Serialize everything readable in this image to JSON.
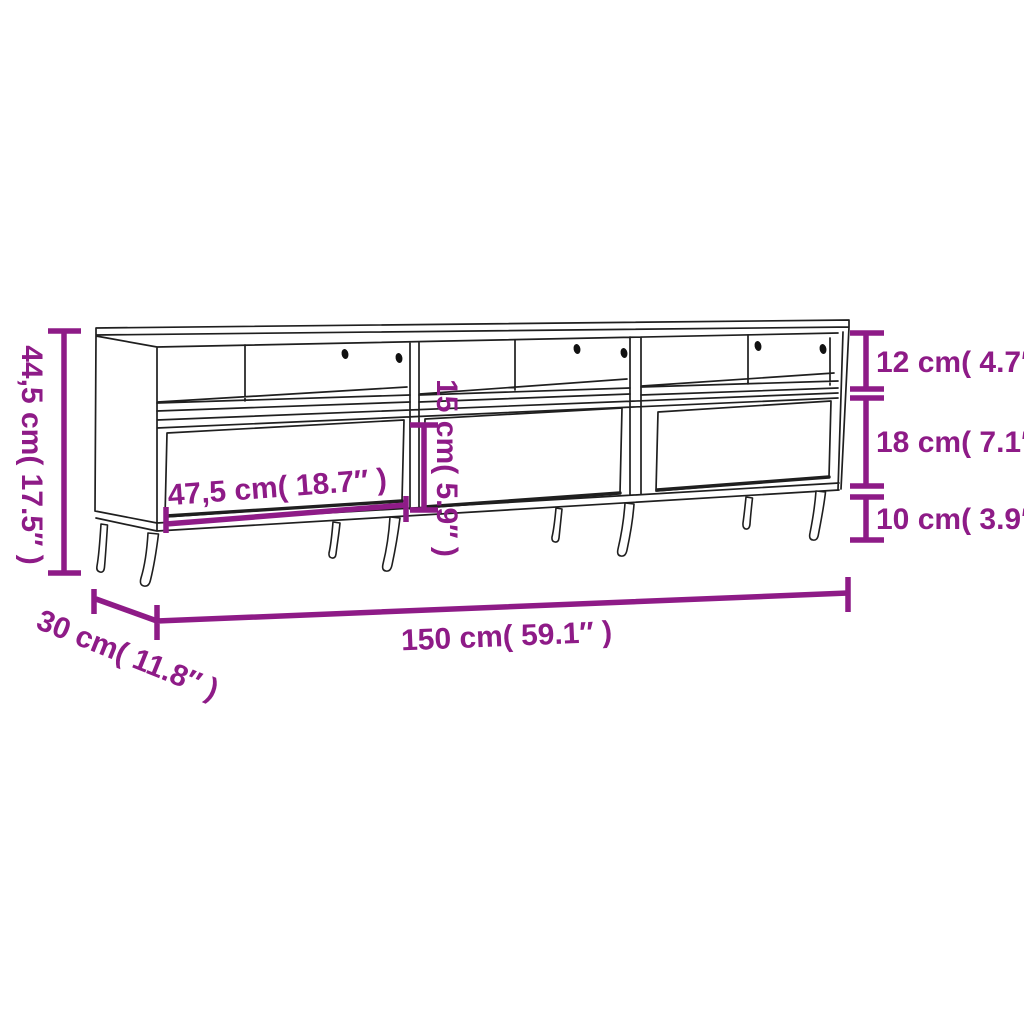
{
  "dimensions": {
    "overall_height": "44,5 cm( 17.5″ )",
    "compartment_height": "12 cm( 4.7″ )",
    "drawer_section_height": "18 cm( 7.1″ )",
    "leg_height": "10 cm( 3.9″ )",
    "drawer_width": "47,5 cm( 18.7″ )",
    "drawer_front_height": "15 cm( 5.9″ )",
    "overall_width": "150 cm( 59.1″ )",
    "overall_depth": "30 cm( 11.8″ )"
  },
  "colors": {
    "dimension_accent": "#8E1B87",
    "line_art": "#1f1f1f",
    "background": "#ffffff"
  }
}
